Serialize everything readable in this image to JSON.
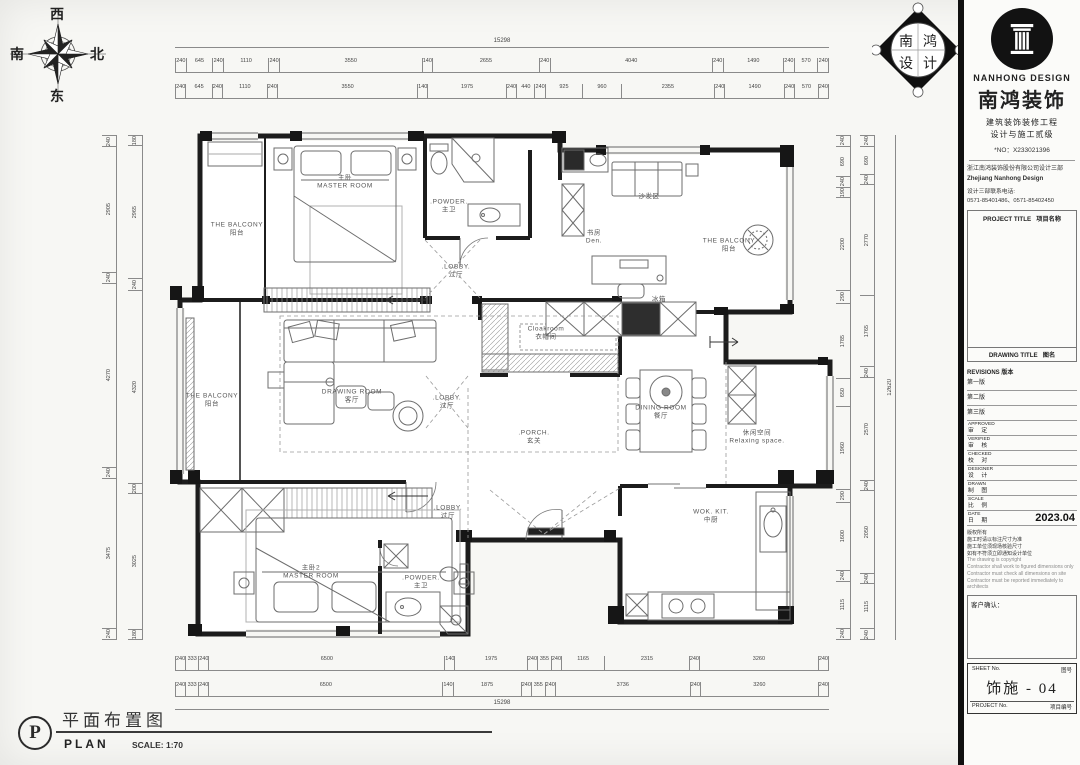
{
  "compass": {
    "top": "西",
    "right": "北",
    "left": "南",
    "bottom": "东"
  },
  "diamond": {
    "c1": "南",
    "c2": "鸿",
    "c3": "设",
    "c4": "计"
  },
  "caption": {
    "letter": "P",
    "title_cn": "平面布置图",
    "title_en": "PLAN",
    "scale": "SCALE: 1:70"
  },
  "titleblock": {
    "company_en": "NANHONG DESIGN",
    "company_cn": "南鸿装饰",
    "cert_line1": "建筑装饰装修工程",
    "cert_line2": "设计与施工贰级",
    "cert_no": "*NO：X233021396",
    "dept_cn": "浙江南鸿装饰股份有限公司设计三部",
    "dept_en": "Zhejiang Nanhong Design",
    "phone_label": "设计三部联系电话:",
    "phone_numbers": "0571-85401486、0571-85402450",
    "project_title_en": "PROJECT TITLE",
    "project_title_cn": "项目名称",
    "drawing_title_en": "DRAWING TITLE",
    "drawing_title_cn": "图名",
    "revisions_label": "REVISIONS  版本",
    "revisions": [
      "第一版",
      "第二版",
      "第三版"
    ],
    "fields": [
      {
        "en": "APPROVED",
        "cn": "审 定"
      },
      {
        "en": "VERIFIED",
        "cn": "审 核"
      },
      {
        "en": "CHECKED",
        "cn": "校 对"
      },
      {
        "en": "DESIGNER",
        "cn": "设 计"
      },
      {
        "en": "DRAWN",
        "cn": "制 图"
      },
      {
        "en": "SCALE",
        "cn": "比 例"
      },
      {
        "en": "DATE",
        "cn": "日 期",
        "value": "2023.04"
      }
    ],
    "notes": [
      "版权所有",
      "施工时请以标注尺寸为准",
      "施工单位须现场核验尺寸",
      "如有不符须立即通知设计单位",
      "The drawing is copyright",
      "Contractor shall work to figured dimensions only",
      "Contractor must check all dimensions on site",
      "Contractor must be reported immediately to architects"
    ],
    "client_confirm_label": "客户确认：",
    "sheet_no_en": "SHEET No.",
    "sheet_no_cn": "图号",
    "sheet_no_value": "饰施 - 04",
    "project_no_en": "PROJECT No.",
    "project_no_cn": "项目编号"
  },
  "rooms": [
    {
      "lines": [
        "主卧",
        "MASTER ROOM"
      ],
      "x": 345,
      "y": 183
    },
    {
      "lines": [
        "THE BALCONY",
        "阳台"
      ],
      "x": 237,
      "y": 230
    },
    {
      "lines": [
        ".POWDER.",
        "主卫"
      ],
      "x": 449,
      "y": 207
    },
    {
      "lines": [
        "沙发区"
      ],
      "x": 649,
      "y": 197
    },
    {
      "lines": [
        "书房",
        "Den."
      ],
      "x": 594,
      "y": 238
    },
    {
      "lines": [
        "THE BALCONY",
        "阳台"
      ],
      "x": 729,
      "y": 246
    },
    {
      "lines": [
        ".LOBBY.",
        "过厅"
      ],
      "x": 456,
      "y": 272
    },
    {
      "lines": [
        "Cloakroom",
        "衣帽间"
      ],
      "x": 546,
      "y": 334
    },
    {
      "lines": [
        "冰箱"
      ],
      "x": 659,
      "y": 300
    },
    {
      "lines": [
        "DRAWING ROOM",
        "客厅"
      ],
      "x": 352,
      "y": 397
    },
    {
      "lines": [
        "THE BALCONY",
        "阳台"
      ],
      "x": 212,
      "y": 401
    },
    {
      "lines": [
        ".LOBBY.",
        "过厅"
      ],
      "x": 447,
      "y": 403
    },
    {
      "lines": [
        ".PORCH.",
        "玄关"
      ],
      "x": 534,
      "y": 438
    },
    {
      "lines": [
        "DINING ROOM",
        "餐厅"
      ],
      "x": 661,
      "y": 413
    },
    {
      "lines": [
        "休闲空间",
        "Relaxing space."
      ],
      "x": 757,
      "y": 438
    },
    {
      "lines": [
        ".LOBBY.",
        "过厅"
      ],
      "x": 448,
      "y": 513
    },
    {
      "lines": [
        "主卧2",
        "MASTER ROOM"
      ],
      "x": 311,
      "y": 573
    },
    {
      "lines": [
        ".POWDER.",
        "主卫"
      ],
      "x": 421,
      "y": 583
    },
    {
      "lines": [
        "WOK. KIT.",
        "中厨"
      ],
      "x": 711,
      "y": 517
    }
  ],
  "dims": {
    "top_total": "15298",
    "top_row1": [
      240,
      645,
      240,
      1110,
      240,
      3550,
      140,
      2655,
      240,
      4040,
      240,
      1490,
      240,
      570,
      240
    ],
    "top_row2": [
      240,
      645,
      240,
      1110,
      240,
      3550,
      140,
      1975,
      240,
      440,
      240,
      925,
      960,
      2355,
      240,
      1490,
      240,
      570,
      240
    ],
    "bottom_row1": [
      240,
      333,
      240,
      6500,
      140,
      1975,
      240,
      355,
      240,
      1165,
      2315,
      240,
      3260,
      240
    ],
    "bottom_row2": [
      240,
      333,
      240,
      6500,
      140,
      1875,
      240,
      355,
      240,
      3736,
      240,
      3260,
      240
    ],
    "bottom_total": "15298",
    "left_col1": [
      240,
      2905,
      240,
      4270,
      240,
      3475,
      240
    ],
    "left_col2": [
      180,
      2965,
      240,
      4320,
      200,
      3025,
      180
    ],
    "right_col1": [
      240,
      690,
      240,
      190,
      2200,
      290,
      1785,
      650,
      1960,
      290,
      1600,
      240,
      1115,
      240
    ],
    "right_col2": [
      240,
      690,
      240,
      2770,
      1765,
      240,
      2570,
      240,
      2050,
      240,
      1115,
      240
    ],
    "right_total": "12620"
  }
}
